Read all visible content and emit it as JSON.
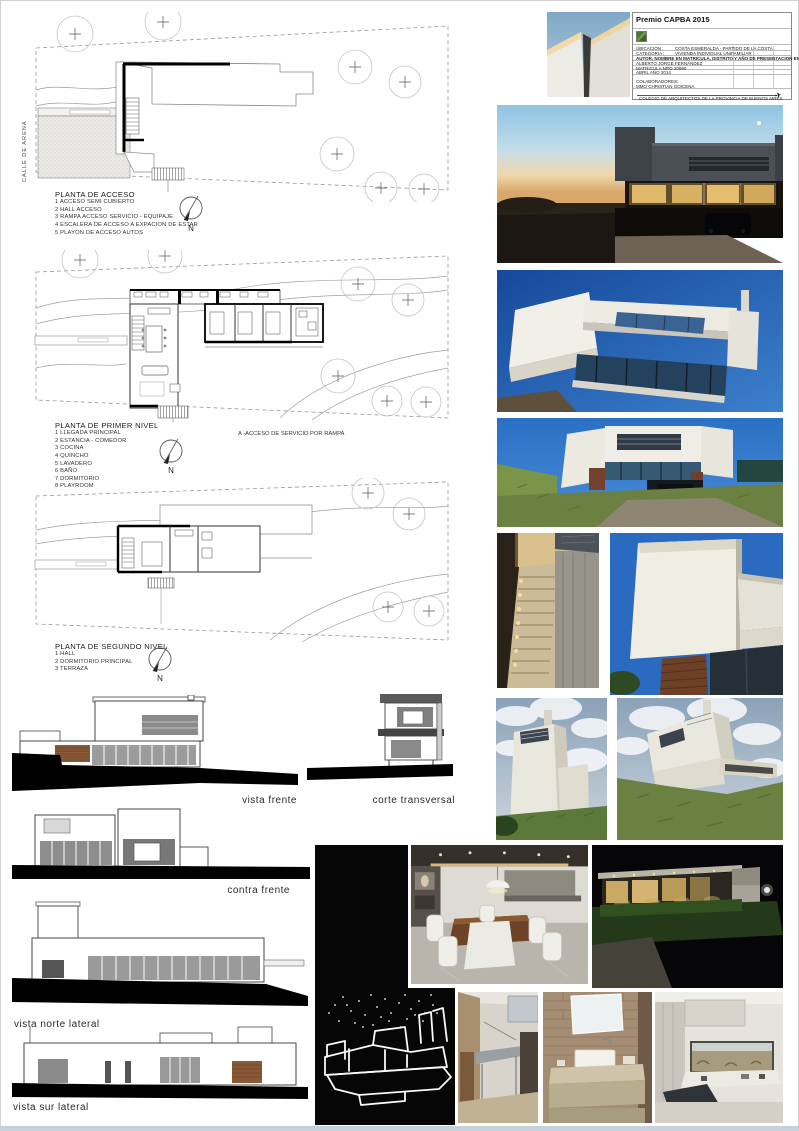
{
  "sheet": {
    "street_label": "CALLE DE ARENA",
    "compass_letter": "N"
  },
  "plan_acceso": {
    "title": "PLANTA DE ACCESO",
    "items": [
      "1 ACCESO SEMI CUBIERTO",
      "2 HALL  ACCESO",
      "3 RAMPA ACCESO SERVICIO - EQUIPAJE",
      "4 ESCALERA DE ACCESO A EXPACION DE  ESTAR",
      "5 PLAYON DE ACCESO AUTOS"
    ]
  },
  "plan_primer": {
    "title": "PLANTA DE PRIMER NIVEL",
    "note": "A -ACCESO DE SERVICIO POR RAMPA",
    "items": [
      "1 LLEGADA PRINCIPAL",
      "2 ESTANCIA - COMEDOR",
      "3 COCINA",
      "4 QUINCHO",
      "5 LAVADERO",
      "6 BAÑO",
      "7 DORMITORIO",
      "8 PLAYROOM"
    ]
  },
  "plan_segundo": {
    "title": "PLANTA DE SEGUNDO NIVEL",
    "items": [
      "1 HALL",
      "2 DORMITORIO PRINCIPAL",
      "3 TERRAZA"
    ]
  },
  "views": {
    "vista_frente": "vista frente",
    "corte_transversal": "corte transversal",
    "contra_frente": "contra frente",
    "vista_norte": "vista norte lateral",
    "vista_sur": "vista sur lateral"
  },
  "titleblock": {
    "title": "Premio CAPBA 2015",
    "ubicacion_label": "UBICACIÓN :",
    "ubicacion_value": "COSTA ESMERALDA - PARTIDO DE LA COSTA",
    "categoria_label": "CATEGORIA :",
    "categoria_value": "VIVIENDA INDIVIDUAL UNIFAMILIAR",
    "autor_heading": "AUTOR, NOMBRE EN MATRICULA, DISTRITO Y AÑO DE PRESENTACION EN EL CAPBA",
    "autor_nombre": "ALBERTO JORGE FERNANDEZ",
    "matricula": "MATRICULA NRO 20990",
    "fecha": "ABRIL AÑO 2014",
    "colaboradores_label": "COLABORADORES:",
    "colaboradores_value": "MMO CHRISTIAN GOICENA",
    "footer": "COLEGIO DE ARQUITECTOS DE LA PROVINCIA DE BUENOS AIRES"
  },
  "colors": {
    "dusk_sky": "#a8d4e8",
    "deep_blue_sky": "#1c58aa",
    "day_blue_sky": "#2a70c4",
    "grass_green": "#6b8142",
    "ground_black": "#000000",
    "drawing_line": "#555555",
    "panel_black": "#060606",
    "warm_window_glow": "#e0b96a"
  }
}
